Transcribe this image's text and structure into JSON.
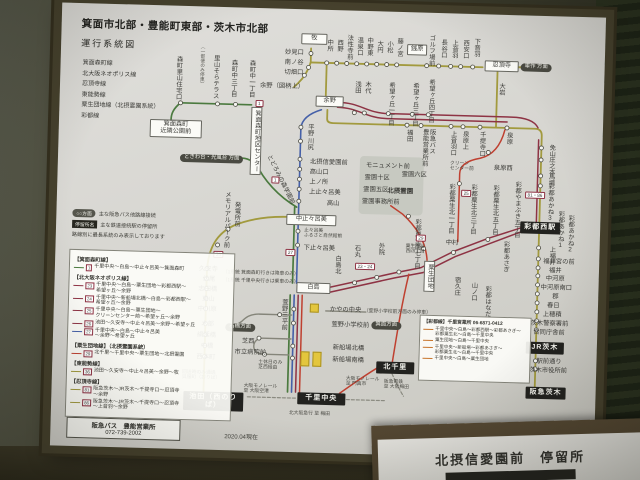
{
  "colors": {
    "olive": "#a29a3e",
    "green": "#4b7a3f",
    "blue": "#4560a8",
    "maroon": "#8e3344",
    "red": "#bf4030",
    "orange": "#c8742a",
    "gray": "#85857a"
  },
  "paper": {
    "title": "箕面市北部・豊能町東部・茨木市北部",
    "subtitle": "運行系統図",
    "line_list": [
      "箕面森町線",
      "北大阪ネオポリス線",
      "忍頂寺線",
      "東能勢線",
      "粟生団地線（北摂霊園系統）",
      "彩都線"
    ],
    "legend_top": [
      {
        "tag": "○○方面",
        "style": "pill",
        "text": "主な阪急バス他路線接続"
      },
      {
        "tag": "停留所名",
        "style": "dark",
        "text": "主な鉄道接続駅の停留所"
      },
      {
        "text": "路線別に最長系統のみ表示しております"
      }
    ],
    "legend_sections": [
      {
        "title": "【箕面森町線】",
        "routes": [
          {
            "num": "1",
            "color": "green",
            "text": "千里中央～白島～中止々呂美～箕面森町"
          }
        ]
      },
      {
        "title": "【北大阪ネオポリス線】",
        "routes": [
          {
            "num": "23",
            "color": "maroon",
            "text": "千里中央～白島～粟生団地～彩都西駅～\n希望ヶ丘～余野"
          },
          {
            "num": "24",
            "color": "maroon",
            "text": "千里中央～新船場北橋～白島～彩都西駅～\n希望ヶ丘～余野"
          },
          {
            "num": "25",
            "color": "maroon",
            "text": "千里中央～白島～粟生団地～\nクリーンセンター前～希望ヶ丘～余野"
          },
          {
            "num": "26",
            "color": "maroon",
            "text": "池田～久安寺～中止々呂美～余野～希望ヶ丘"
          },
          {
            "num": "27",
            "color": "blue",
            "text": "千里中央～白島～中止々呂美\n～余野～希望ヶ丘"
          }
        ]
      },
      {
        "title": "【粟生団地線】（北摂霊園系統）",
        "routes": [
          {
            "num": "29",
            "color": "red",
            "text": "北千里～千里中央～粟生団地～北摂霊園"
          }
        ]
      },
      {
        "title": "【東能勢線】",
        "routes": [
          {
            "num": "36",
            "color": "olive",
            "text": "池田～久安寺～中止々呂美～余野～牧"
          }
        ]
      },
      {
        "title": "【忍頂寺線】",
        "routes": [
          {
            "num": "81",
            "color": "olive",
            "text": "阪急茨木～JR茨木～千提寺口～忍頂寺\n～余野"
          },
          {
            "num": "86",
            "color": "olive",
            "text": "阪急茨木～JR茨木～千提寺口～忍頂寺\n～上音羽～余野"
          }
        ]
      }
    ],
    "saito": {
      "title": "【彩都線】千里営業所 06-6871-0412",
      "routes": [
        "千里中央～白島～彩都西駅～彩都あさぎ～\n彩都粟生北～白島～千里中央",
        "粟生団地～白島～千里中央",
        "千里中央～新船場～彩都あさぎ～\n彩都粟生北～白島～千里中央",
        "千里中央～白島～粟生団地"
      ]
    },
    "office": {
      "name": "阪急バス　豊能営業所",
      "tel": "072-739-2002"
    },
    "date": "2020.04現在"
  },
  "map": {
    "labels": [
      {
        "t": "森町里山住宅口",
        "x": 114,
        "y": 50,
        "c": "v"
      },
      {
        "t": "里山そらテラス",
        "x": 151,
        "y": 48,
        "c": "v"
      },
      {
        "t": "（一部便のみ停車）",
        "x": 140,
        "y": 38,
        "c": "notev"
      },
      {
        "t": "森町中三丁目",
        "x": 169,
        "y": 52,
        "c": "v"
      },
      {
        "t": "森町中一丁目",
        "x": 187,
        "y": 52,
        "c": "v"
      },
      {
        "t": "箕面森町\n近隣公園前",
        "x": 91,
        "y": 114,
        "c": "box",
        "w": 46
      },
      {
        "t": "箕面森町地区センター",
        "x": 192,
        "y": 99,
        "c": "boxv"
      },
      {
        "t": "ときわ台・光風台 方面",
        "x": 122,
        "y": 148,
        "c": "pill"
      },
      {
        "t": "とどろみの森学園前",
        "x": 213,
        "y": 146,
        "c": "diag"
      },
      {
        "t": "牧",
        "x": 240,
        "y": 24,
        "c": "box",
        "w": 20
      },
      {
        "t": "妙見口",
        "x": 224,
        "y": 41,
        "c": "h"
      },
      {
        "t": "南ノ谷",
        "x": 224,
        "y": 51,
        "c": "h"
      },
      {
        "t": "切畑口",
        "x": 224,
        "y": 61,
        "c": "h"
      },
      {
        "t": "余野（図柄上）",
        "x": 200,
        "y": 75,
        "c": "h"
      },
      {
        "t": "余野",
        "x": 256,
        "y": 86,
        "c": "box",
        "w": 22
      },
      {
        "t": "中所",
        "x": 264,
        "y": 29,
        "c": "v"
      },
      {
        "t": "西野",
        "x": 274,
        "y": 29,
        "c": "v"
      },
      {
        "t": "法性寺前",
        "x": 284,
        "y": 24,
        "c": "v"
      },
      {
        "t": "温泉口",
        "x": 294,
        "y": 26,
        "c": "v"
      },
      {
        "t": "中野東",
        "x": 304,
        "y": 26,
        "c": "v"
      },
      {
        "t": "大円",
        "x": 314,
        "y": 29,
        "c": "v"
      },
      {
        "t": "小松",
        "x": 324,
        "y": 29,
        "c": "v"
      },
      {
        "t": "藤ノ宮",
        "x": 334,
        "y": 26,
        "c": "v"
      },
      {
        "t": "銭原",
        "x": 346,
        "y": 32,
        "c": "box",
        "w": 14
      },
      {
        "t": "ゴルフ場前",
        "x": 366,
        "y": 22,
        "c": "v"
      },
      {
        "t": "長谷口",
        "x": 378,
        "y": 26,
        "c": "v"
      },
      {
        "t": "上音羽",
        "x": 389,
        "y": 26,
        "c": "v"
      },
      {
        "t": "西安口",
        "x": 400,
        "y": 26,
        "c": "v"
      },
      {
        "t": "下音羽",
        "x": 411,
        "y": 24,
        "c": "v"
      },
      {
        "t": "忍頂寺",
        "x": 424,
        "y": 46,
        "c": "box",
        "w": 28
      },
      {
        "t": "車作 方面",
        "x": 460,
        "y": 48,
        "c": "pill"
      },
      {
        "t": "大岩",
        "x": 437,
        "y": 68,
        "c": "v"
      },
      {
        "t": "福田",
        "x": 346,
        "y": 117,
        "c": "v"
      },
      {
        "t": "阪急バス\n豊能営業所前",
        "x": 362,
        "y": 116,
        "c": "v2"
      },
      {
        "t": "上音羽口",
        "x": 390,
        "y": 117,
        "c": "v"
      },
      {
        "t": "泉原上",
        "x": 402,
        "y": 117,
        "c": "v"
      },
      {
        "t": "千提寺口",
        "x": 419,
        "y": 117,
        "c": "v"
      },
      {
        "t": "泉原",
        "x": 446,
        "y": 117,
        "c": "v"
      },
      {
        "t": "免山",
        "x": 489,
        "y": 128,
        "c": "v"
      },
      {
        "t": "庄之本",
        "x": 489,
        "y": 140,
        "c": "v"
      },
      {
        "t": "馬場",
        "x": 489,
        "y": 157,
        "c": "v"
      },
      {
        "t": "彩都あかね3",
        "x": 489,
        "y": 167,
        "c": "v"
      },
      {
        "t": "彩都西駅",
        "x": 464,
        "y": 206,
        "c": "sta",
        "w": 36
      },
      {
        "t": "彩都あかね1",
        "x": 500,
        "y": 194,
        "c": "v"
      },
      {
        "t": "彩都あかね2",
        "x": 510,
        "y": 198,
        "c": "v"
      },
      {
        "t": "彩都あさぎ",
        "x": 446,
        "y": 226,
        "c": "v"
      },
      {
        "t": "上福井",
        "x": 492,
        "y": 230,
        "c": "v"
      },
      {
        "t": "福井宮の前",
        "x": 488,
        "y": 243,
        "c": "h"
      },
      {
        "t": "福井",
        "x": 494,
        "y": 252,
        "c": "h"
      },
      {
        "t": "中河原",
        "x": 491,
        "y": 260,
        "c": "h"
      },
      {
        "t": "中河原南口",
        "x": 486,
        "y": 269,
        "c": "h"
      },
      {
        "t": "郡",
        "x": 498,
        "y": 278,
        "c": "h"
      },
      {
        "t": "春日",
        "x": 493,
        "y": 287,
        "c": "h"
      },
      {
        "t": "上穂積",
        "x": 489,
        "y": 296,
        "c": "h"
      },
      {
        "t": "茨木警察署前",
        "x": 477,
        "y": 305,
        "c": "h"
      },
      {
        "t": "合同庁舎前",
        "x": 480,
        "y": 314,
        "c": "h"
      },
      {
        "t": "JR茨木",
        "x": 473,
        "y": 326,
        "c": "sta",
        "w": 34
      },
      {
        "t": "駅前通り",
        "x": 484,
        "y": 343,
        "c": "h"
      },
      {
        "t": "茨木市役所前",
        "x": 477,
        "y": 352,
        "c": "h"
      },
      {
        "t": "阪急茨木",
        "x": 474,
        "y": 371,
        "c": "sta",
        "w": 36
      },
      {
        "t": "浅田",
        "x": 293,
        "y": 70,
        "c": "v"
      },
      {
        "t": "木代",
        "x": 303,
        "y": 70,
        "c": "v"
      },
      {
        "t": "希望ヶ丘一丁目",
        "x": 327,
        "y": 70,
        "c": "v"
      },
      {
        "t": "希望ヶ丘三丁目",
        "x": 351,
        "y": 70,
        "c": "v"
      },
      {
        "t": "希望ヶ丘四丁目",
        "x": 367,
        "y": 66,
        "c": "v"
      },
      {
        "t": "平野",
        "x": 247,
        "y": 114,
        "c": "v"
      },
      {
        "t": "川尻",
        "x": 247,
        "y": 128,
        "c": "v"
      },
      {
        "t": "北摂信愛園前",
        "x": 252,
        "y": 150,
        "c": "h"
      },
      {
        "t": "高山口",
        "x": 252,
        "y": 160,
        "c": "h"
      },
      {
        "t": "上ノ所",
        "x": 252,
        "y": 170,
        "c": "h"
      },
      {
        "t": "上止々呂美",
        "x": 252,
        "y": 180,
        "c": "h"
      },
      {
        "t": "高山",
        "x": 270,
        "y": 191,
        "c": "h"
      },
      {
        "t": "中止々呂美",
        "x": 230,
        "y": 205,
        "c": "box",
        "w": 44
      },
      {
        "t": "止々呂美\nふるさと自然館前",
        "x": 248,
        "y": 219,
        "c": "note"
      },
      {
        "t": "下止々呂美",
        "x": 248,
        "y": 236,
        "c": "h"
      },
      {
        "t": "石丸",
        "x": 297,
        "y": 234,
        "c": "v"
      },
      {
        "t": "白島北",
        "x": 278,
        "y": 245,
        "c": "v"
      },
      {
        "t": "外院",
        "x": 321,
        "y": 231,
        "c": "v"
      },
      {
        "t": "白島",
        "x": 242,
        "y": 273,
        "c": "box",
        "w": 28
      },
      {
        "t": "（1系統 箕面森町行きは降車のみ）",
        "x": 168,
        "y": 263,
        "c": "note"
      },
      {
        "t": "（1系統 千里中央行きは乗車のみ）",
        "x": 168,
        "y": 271,
        "c": "note"
      },
      {
        "t": "粟生間谷\n西四丁目",
        "x": 350,
        "y": 232,
        "c": "note"
      },
      {
        "t": "粟生団地",
        "x": 369,
        "y": 248,
        "c": "boxv"
      },
      {
        "t": "中村",
        "x": 390,
        "y": 227,
        "c": "h"
      },
      {
        "t": "宿久庄",
        "x": 398,
        "y": 263,
        "c": "v"
      },
      {
        "t": "山ノ口",
        "x": 415,
        "y": 268,
        "c": "v"
      },
      {
        "t": "彩都はなだ",
        "x": 429,
        "y": 271,
        "c": "v"
      },
      {
        "t": "彩都粟生南七丁目",
        "x": 357,
        "y": 206,
        "c": "v"
      },
      {
        "t": "彩都粟生北一丁目",
        "x": 390,
        "y": 170,
        "c": "v"
      },
      {
        "t": "彩都粟生北三丁目",
        "x": 412,
        "y": 170,
        "c": "v"
      },
      {
        "t": "彩都粟生北五丁目",
        "x": 434,
        "y": 170,
        "c": "v"
      },
      {
        "t": "彩都やまぶき五丁目",
        "x": 456,
        "y": 166,
        "c": "v"
      },
      {
        "t": "モニュメント前",
        "x": 308,
        "y": 152,
        "c": "h"
      },
      {
        "t": "霊園十区",
        "x": 307,
        "y": 164,
        "c": "h"
      },
      {
        "t": "霊園六区",
        "x": 344,
        "y": 160,
        "c": "h"
      },
      {
        "t": "霊園五区",
        "x": 306,
        "y": 176,
        "c": "h"
      },
      {
        "t": "北摂霊園",
        "x": 330,
        "y": 176,
        "c": "hb"
      },
      {
        "t": "霊園事務所前",
        "x": 305,
        "y": 188,
        "c": "h"
      },
      {
        "t": "クリーン\nセンター前",
        "x": 392,
        "y": 148,
        "c": "note"
      },
      {
        "t": "泉原西",
        "x": 436,
        "y": 151,
        "c": "h"
      },
      {
        "t": "久安寺",
        "x": 144,
        "y": 260,
        "c": "h"
      },
      {
        "t": "伏尾",
        "x": 148,
        "y": 270,
        "c": "h"
      },
      {
        "t": "志田橋",
        "x": 144,
        "y": 280,
        "c": "h"
      },
      {
        "t": "東山",
        "x": 148,
        "y": 290,
        "c": "h"
      },
      {
        "t": "中川原",
        "x": 144,
        "y": 300,
        "c": "h"
      },
      {
        "t": "木部",
        "x": 148,
        "y": 315,
        "c": "h"
      },
      {
        "t": "絹延橋",
        "x": 144,
        "y": 326,
        "c": "h"
      },
      {
        "t": "中橋",
        "x": 148,
        "y": 337,
        "c": "h"
      },
      {
        "t": "西本町",
        "x": 144,
        "y": 348,
        "c": "h"
      },
      {
        "t": "池田（西のりば）",
        "x": 132,
        "y": 385,
        "c": "sta",
        "w": 56
      },
      {
        "t": "回送時のみ通過\n呉服町（おりば）",
        "x": 130,
        "y": 364,
        "c": "note"
      },
      {
        "t": "メモリアルパーク前",
        "x": 166,
        "y": 184,
        "c": "v"
      },
      {
        "t": "発電所前",
        "x": 176,
        "y": 194,
        "c": "v"
      },
      {
        "t": "萱野三平前",
        "x": 226,
        "y": 290,
        "c": "v"
      },
      {
        "t": "石橋方面",
        "x": 172,
        "y": 316,
        "c": "pill"
      },
      {
        "t": "芝西",
        "x": 189,
        "y": 331,
        "c": "h"
      },
      {
        "t": "市立病院前",
        "x": 182,
        "y": 342,
        "c": "h"
      },
      {
        "t": "土休日のみ\n芝西経由",
        "x": 206,
        "y": 352,
        "c": "note"
      },
      {
        "t": "かやの中央",
        "x": 276,
        "y": 297,
        "c": "h"
      },
      {
        "t": "（萱野小学校前方面のみ停車）",
        "x": 310,
        "y": 298,
        "c": "note"
      },
      {
        "t": "萱野小学校前",
        "x": 278,
        "y": 312,
        "c": "h"
      },
      {
        "t": "箕面方面",
        "x": 318,
        "y": 310,
        "c": "pill"
      },
      {
        "t": "新船場北橋",
        "x": 280,
        "y": 335,
        "c": "h"
      },
      {
        "t": "新船場南橋",
        "x": 280,
        "y": 347,
        "c": "h"
      },
      {
        "t": "千里中央",
        "x": 246,
        "y": 383,
        "c": "sta",
        "w": 44
      },
      {
        "t": "北千里",
        "x": 324,
        "y": 350,
        "c": "sta",
        "w": 34
      },
      {
        "t": "大阪モノレール\n至 大阪空港",
        "x": 192,
        "y": 376,
        "c": "note"
      },
      {
        "t": "大阪モノレール\n至 門真市",
        "x": 294,
        "y": 366,
        "c": "note"
      },
      {
        "t": "北大阪急行 至 梅田",
        "x": 238,
        "y": 402,
        "c": "note"
      },
      {
        "t": "阪急電鉄\n至 大阪梅田",
        "x": 332,
        "y": 368,
        "c": "note"
      },
      {
        "t": "1",
        "x": 214,
        "y": 168,
        "c": "chip"
      },
      {
        "t": "1",
        "x": 196,
        "y": 92,
        "c": "chip"
      },
      {
        "t": "27",
        "x": 230,
        "y": 240,
        "c": "chip"
      },
      {
        "t": "36",
        "x": 158,
        "y": 244,
        "c": "chip"
      },
      {
        "t": "29",
        "x": 360,
        "y": 222,
        "c": "chip"
      },
      {
        "t": "23・24",
        "x": 300,
        "y": 252,
        "c": "chip"
      },
      {
        "t": "25",
        "x": 404,
        "y": 176,
        "c": "chip"
      },
      {
        "t": "81・86",
        "x": 468,
        "y": 176,
        "c": "chip"
      }
    ]
  },
  "bottom_sign": {
    "title": "北摂信愛園前　停留所"
  }
}
